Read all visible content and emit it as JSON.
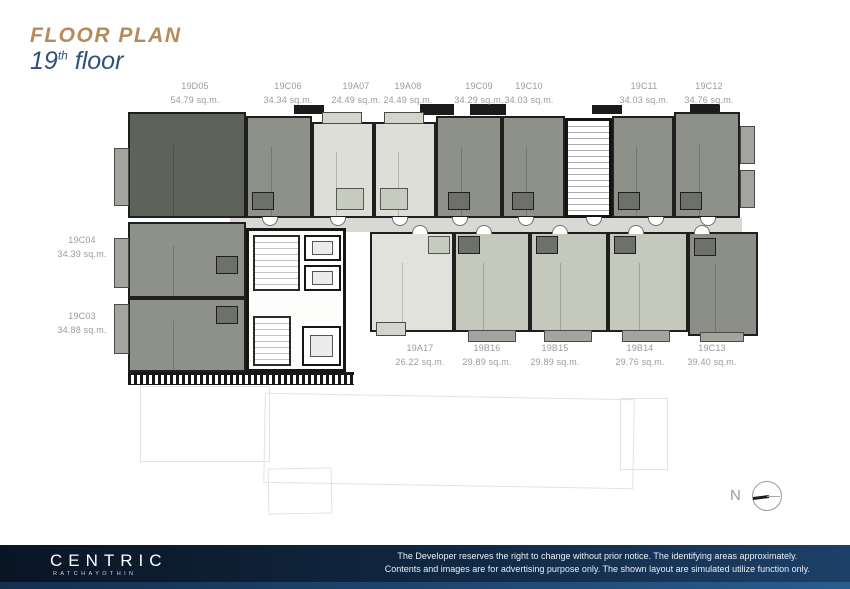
{
  "title": {
    "kicker": "FLOOR PLAN",
    "floor_number": "19",
    "floor_ordinal": "th",
    "floor_word": " floor"
  },
  "units": {
    "top": [
      {
        "id": "19D05",
        "area": "54.79 sq.m."
      },
      {
        "id": "19C06",
        "area": "34.34 sq.m."
      },
      {
        "id": "19A07",
        "area": "24.49 sq.m."
      },
      {
        "id": "19A08",
        "area": "24.49 sq.m."
      },
      {
        "id": "19C09",
        "area": "34.29 sq.m."
      },
      {
        "id": "19C10",
        "area": "34.03 sq.m."
      },
      {
        "id": "19C11",
        "area": "34.03 sq.m."
      },
      {
        "id": "19C12",
        "area": "34.76 sq.m."
      }
    ],
    "left": [
      {
        "id": "19C04",
        "area": "34.39 sq.m."
      },
      {
        "id": "19C03",
        "area": "34.88 sq.m."
      }
    ],
    "bottom": [
      {
        "id": "19A17",
        "area": "26.22 sq.m."
      },
      {
        "id": "19B16",
        "area": "29.89 sq.m."
      },
      {
        "id": "19B15",
        "area": "29.89 sq.m."
      },
      {
        "id": "19B14",
        "area": "29.76 sq.m."
      },
      {
        "id": "19C13",
        "area": "39.40 sq.m."
      }
    ]
  },
  "compass": {
    "label": "N"
  },
  "footer": {
    "brand": "CENTRIC",
    "brand_sub": "RATCHAYOTHIN",
    "disclaimer_line1": "The Developer reserves the right to change without prior notice. The identifying areas approximately.",
    "disclaimer_line2": "Contents and images are for advertising purpose only. The shown layout are simulated utilize function only."
  },
  "colors": {
    "title_gold": "#B48B5B",
    "title_navy": "#31517D",
    "unit_dark": "#5E635A",
    "unit_medium": "#8E908A",
    "unit_light": "#DCDED7",
    "unit_sage": "#C4C8BD",
    "corridor": "#D9D8D2",
    "label_gray": "#9B9B9B",
    "footer_navy_dark": "#0A1524",
    "footer_navy_light": "#1D4068"
  }
}
